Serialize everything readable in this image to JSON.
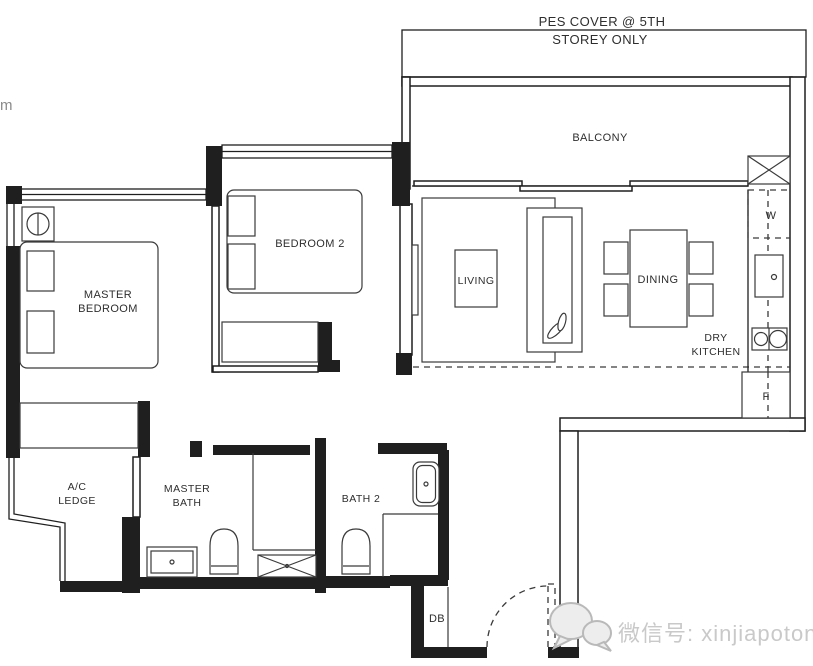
{
  "labels": {
    "edge_fragment": "m",
    "pes_cover": {
      "line1": "PES COVER @ 5TH",
      "line2": "STOREY ONLY"
    },
    "balcony": "BALCONY",
    "master_bedroom": {
      "line1": "MASTER",
      "line2": "BEDROOM"
    },
    "bedroom2": "BEDROOM 2",
    "living": "LIVING",
    "dining": "DINING",
    "dry_kitchen": {
      "line1": "DRY",
      "line2": "KITCHEN"
    },
    "ac_ledge": {
      "line1": "A/C",
      "line2": "LEDGE"
    },
    "master_bath": {
      "line1": "MASTER",
      "line2": "BATH"
    },
    "bath2": "BATH 2",
    "db": "DB",
    "washer": "W",
    "fridge": "F"
  },
  "watermark": {
    "text": "微信号: xinjiapotong",
    "icon": "wechat-logo"
  },
  "colors": {
    "wall": "#1f1f1f",
    "furniture_line": "#3a3a3a",
    "text": "#2e2e2e",
    "watermark": "#c9c9c9",
    "background": "#ffffff"
  }
}
